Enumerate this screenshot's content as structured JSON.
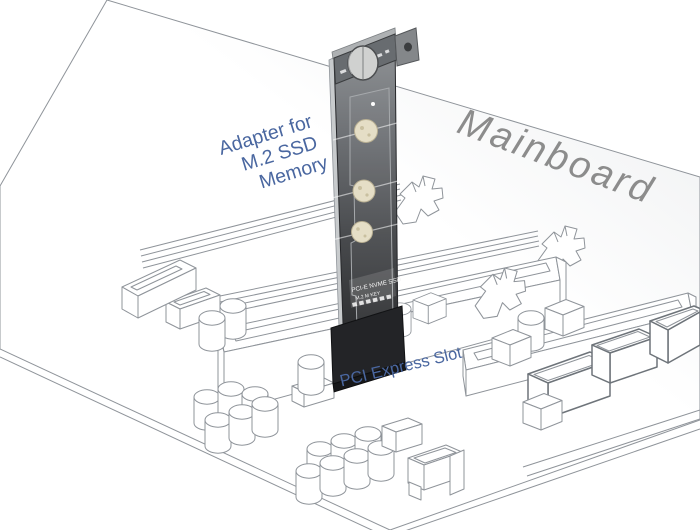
{
  "labels": {
    "adapter": {
      "line1": "Adapter for",
      "line2": "M.2 SSD",
      "line3": "Memory"
    },
    "mainboard": "Mainboard",
    "pci_slot": "PCI Express Slot"
  },
  "card": {
    "print_line1": "PCI-E NVME SSD",
    "print_line2": "M.2 M KEY",
    "standoff_count": 3
  },
  "colors": {
    "label_blue": "#4a67a0",
    "label_gray": "#8c8c8c",
    "line_gray": "#8f949a",
    "card_dark": "#28292b",
    "standoff": "#e5dec6"
  }
}
